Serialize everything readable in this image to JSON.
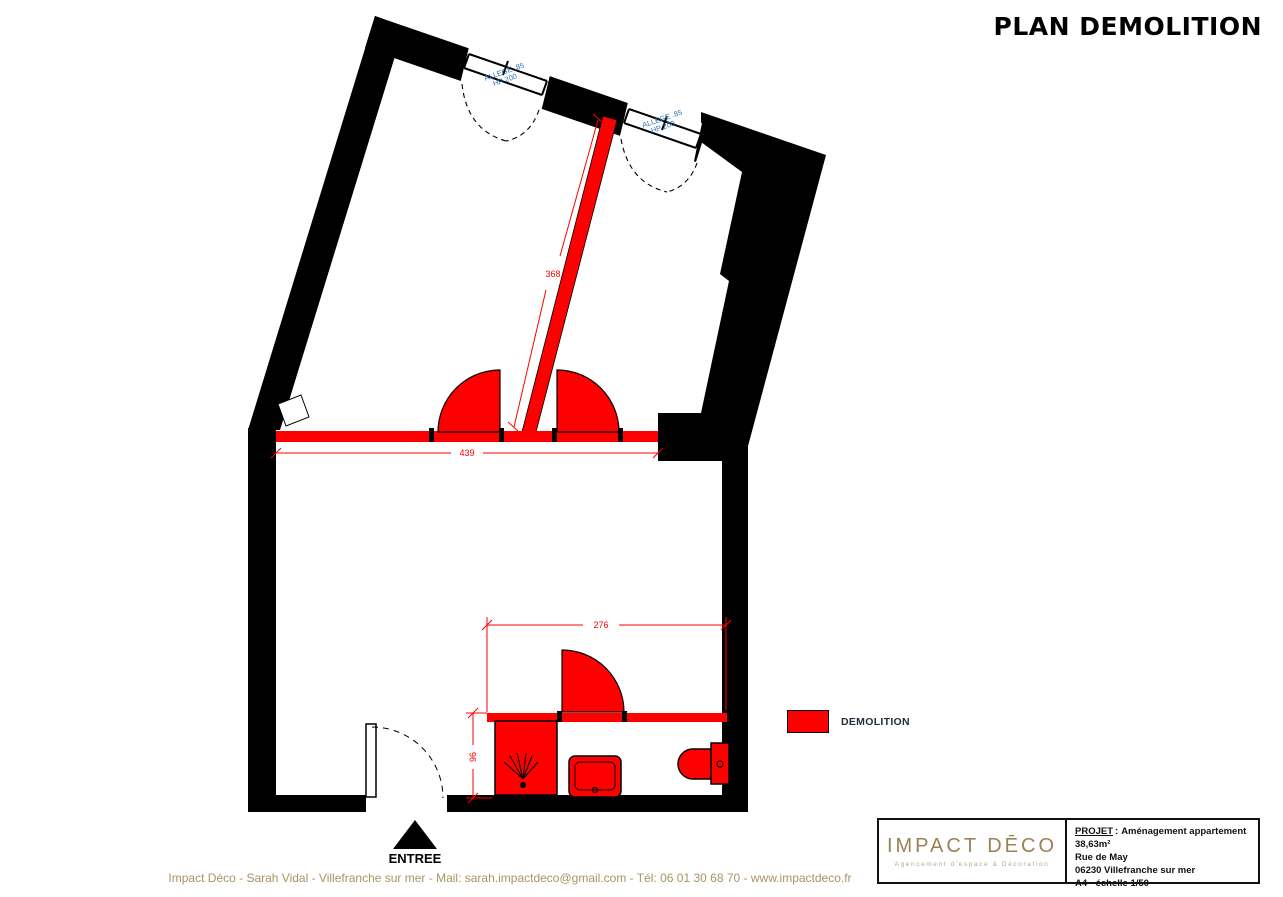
{
  "title": "PLAN DEMOLITION",
  "plan": {
    "windows": [
      {
        "line1": "ALLEGE .85",
        "line2": "HP 200"
      },
      {
        "line1": "ALLEGE .85",
        "line2": "HP 200"
      }
    ],
    "dimensions": {
      "partition_wall": "368",
      "living_wall": "439",
      "bathroom_width": "276",
      "bathroom_depth": "96"
    },
    "entrance_label": "ENTREE"
  },
  "legend": {
    "swatch_color": "#FF0000",
    "label": "DEMOLITION"
  },
  "title_block": {
    "logo_text": "IMPACT DĒCO",
    "logo_tagline": "Agencement d'espace & Décoration",
    "project_label": "PROJET",
    "project_separator": ":",
    "project_value": "Aménagement appartement 38,63m²",
    "address": "Rue de May",
    "city": "06230 Villefranche sur mer",
    "format_scale": "A4 - échelle 1/50"
  },
  "footer": "Impact Déco - Sarah Vidal - Villefranche sur mer -  Mail: sarah.impactdeco@gmail.com - Tél: 06 01 30 68 70 - www.impactdeco.fr",
  "colors": {
    "demolition_red": "#FF0000",
    "window_label_blue": "#2E75B6",
    "brand_gold": "#9A8254",
    "wall_black": "#000000"
  }
}
